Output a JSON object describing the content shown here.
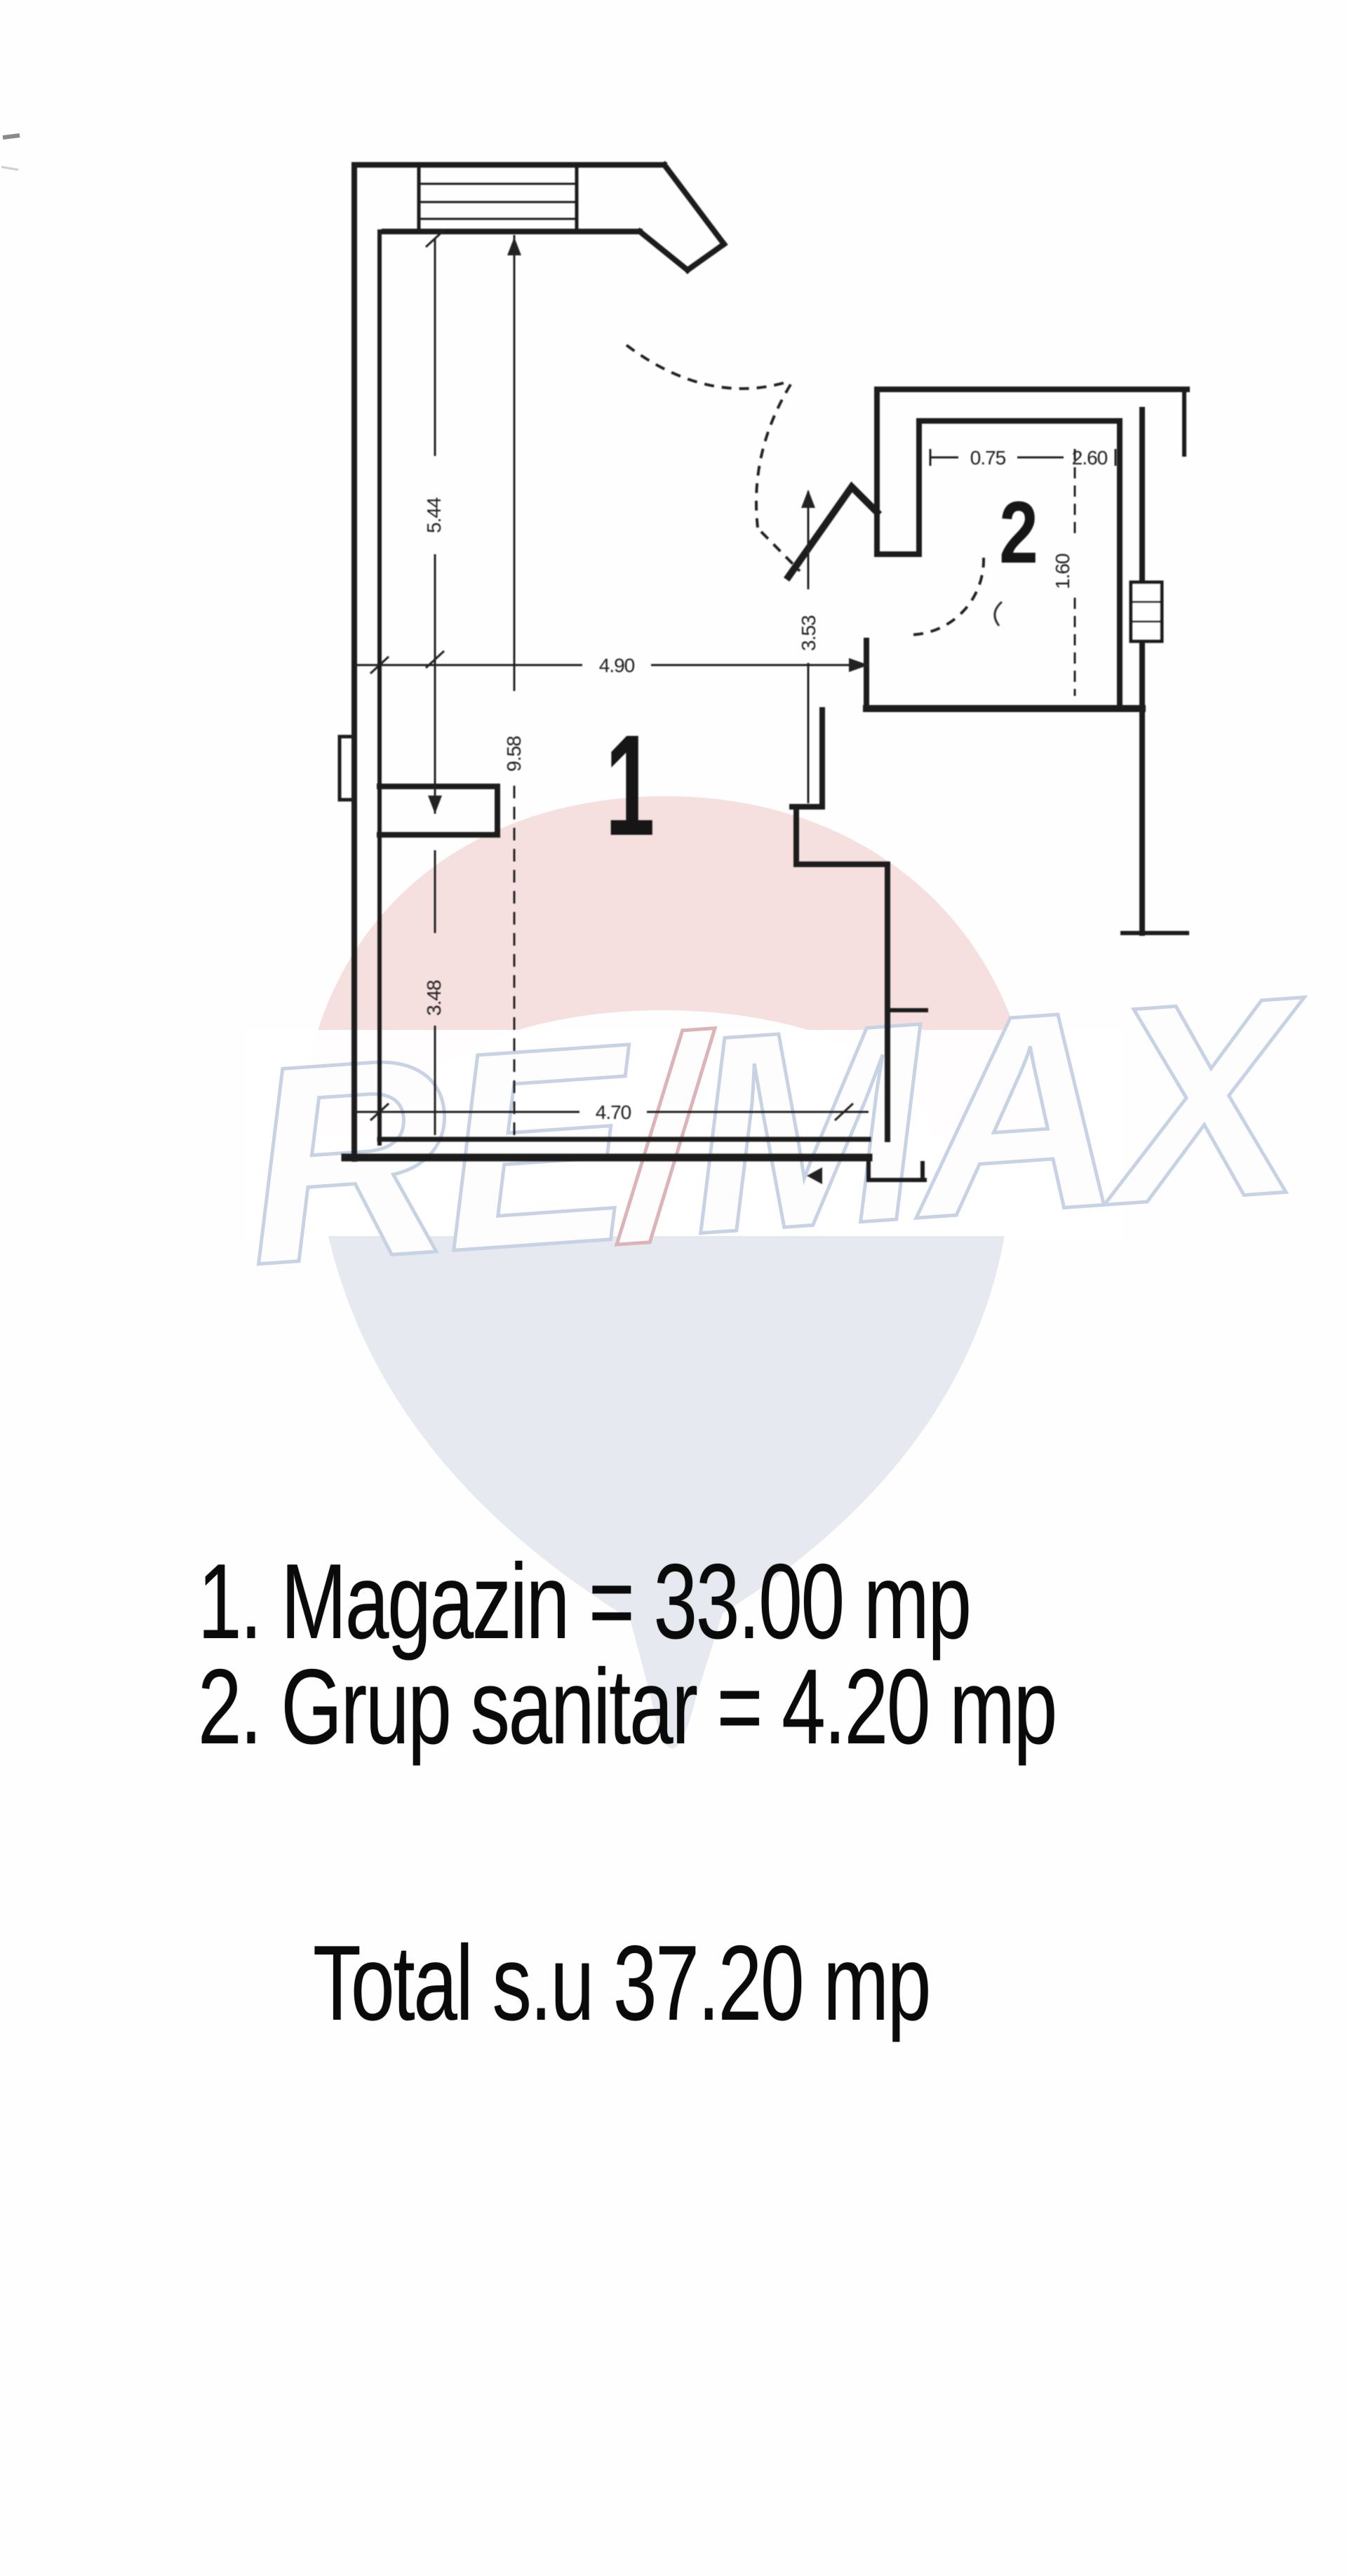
{
  "legend": {
    "line1": "1. Magazin = 33.00 mp",
    "line2": "2. Grup sanitar = 4.20 mp",
    "total": "Total s.u 37.20 mp"
  },
  "floor_plan": {
    "room_labels": {
      "room1": "1",
      "room2": "2"
    },
    "dimensions": {
      "left_height": "5.44",
      "interior_height": "9.58",
      "room1_width": "4.90",
      "right_height": "3.53",
      "bottom_width": "4.70",
      "bottom_left_height": "3.48",
      "room2_niche_width": "0.75",
      "room2_width": "2.60",
      "room2_height": "1.60"
    }
  },
  "watermark": {
    "brand_re": "RE",
    "brand_slash": "/",
    "brand_max": "MAX",
    "colors": {
      "balloon_top_pink": "#f2d3d3",
      "balloon_bottom_gray": "#e3e7ee",
      "letter_outline_blue": "#c7d3e4",
      "slash_red": "#dcb4b8"
    }
  }
}
